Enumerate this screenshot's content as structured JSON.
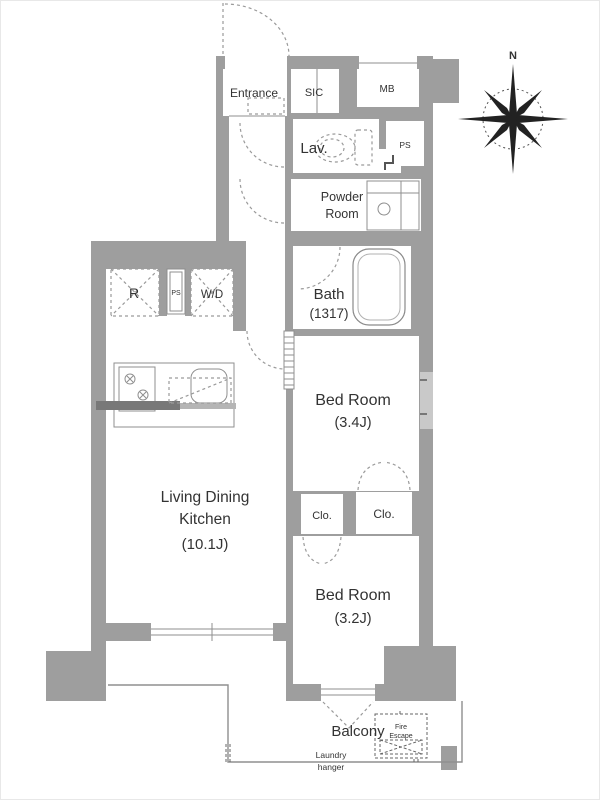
{
  "plan_title": "apartment-floor-plan",
  "colors": {
    "wall_gray": "#9e9e9e",
    "line_gray": "#8f8f8f",
    "text_color": "#333333",
    "window_light": "#c9c9c9",
    "counter_dark": "#787878",
    "background": "#ffffff"
  },
  "labels": {
    "entrance": "Entrance",
    "sic": "SIC",
    "mb": "MB",
    "lav": "Lav.",
    "ps_upper": "PS",
    "powder_1": "Powder",
    "powder_2": "Room",
    "bath": "Bath",
    "bath_size": "(1317)",
    "fridge": "R",
    "ps_mid": "PS",
    "washer": "W/D",
    "bed1": "Bed Room",
    "bed1_size": "(3.4J)",
    "clo1": "Clo.",
    "clo2": "Clo.",
    "ldk_1": "Living Dining",
    "ldk_2": "Kitchen",
    "ldk_size": "(10.1J)",
    "bed2": "Bed Room",
    "bed2_size": "(3.2J)",
    "balcony": "Balcony",
    "laundry_1": "Laundry",
    "laundry_2": "hanger",
    "fire_1": "Fire",
    "fire_2": "Escape",
    "north": "N"
  },
  "rooms": [
    {
      "name": "Entrance"
    },
    {
      "name": "SIC"
    },
    {
      "name": "MB"
    },
    {
      "name": "Lav."
    },
    {
      "name": "PS"
    },
    {
      "name": "Powder Room"
    },
    {
      "name": "Bath",
      "size": "(1317)"
    },
    {
      "name": "R"
    },
    {
      "name": "PS"
    },
    {
      "name": "W/D"
    },
    {
      "name": "Bed Room",
      "size": "(3.4J)"
    },
    {
      "name": "Clo."
    },
    {
      "name": "Clo."
    },
    {
      "name": "Living Dining Kitchen",
      "size": "(10.1J)"
    },
    {
      "name": "Bed Room",
      "size": "(3.2J)"
    },
    {
      "name": "Balcony"
    },
    {
      "name": "Laundry hanger"
    },
    {
      "name": "Fire Escape"
    }
  ]
}
